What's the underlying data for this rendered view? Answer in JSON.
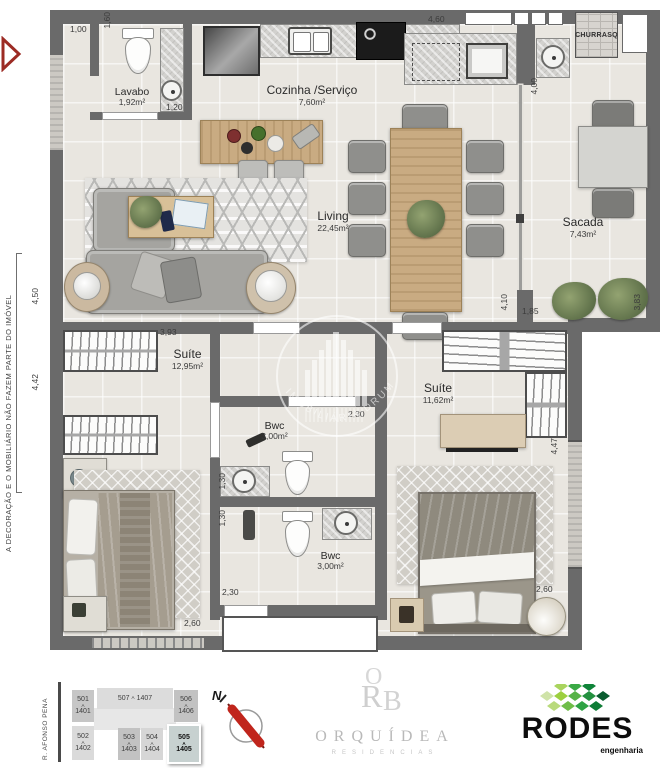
{
  "plan": {
    "rooms": {
      "lavabo": {
        "name": "Lavabo",
        "area": "1,92m²"
      },
      "cozinha": {
        "name": "Cozinha /Serviço",
        "area": "7,60m²"
      },
      "living": {
        "name": "Living",
        "area": "22,45m²"
      },
      "sacada": {
        "name": "Sacada",
        "area": "7,43m²"
      },
      "churrasqueira": {
        "name": "CHURRASQ"
      },
      "suite1": {
        "name": "Suíte",
        "area": "12,95m²"
      },
      "suite2": {
        "name": "Suíte",
        "area": "11,62m²"
      },
      "bwc1": {
        "name": "Bwc",
        "area": "3,00m²"
      },
      "bwc2": {
        "name": "Bwc",
        "area": "3,00m²"
      }
    },
    "dimensions": {
      "lavabo_top": "1,00",
      "lavabo_left": "1,60",
      "lavabo_bottom": "1,20",
      "kitchen_top": "4,60",
      "kitchen_right": "4,00",
      "living_left": "4,50",
      "suite1_top": "3,93",
      "suite1_left": "4,42",
      "suite1_bottom": "2,60",
      "bwc1_top": "2,30",
      "bwc1_left": "1,30",
      "bwc2_left": "1,30",
      "bwc2_bottom": "2,30",
      "sacada_inner": "4,10",
      "sacada_bottom": "1,85",
      "sacada_right": "3,83",
      "suite2_right": "4,47",
      "suite2_bottom": "2,60"
    },
    "disclaimer": "A DECORAÇÃO E O MOBILIÁRIO NÃO FAZEM PARTE DO IMÓVEL",
    "watermark": "IMOBILIÁRIA DRUMOND"
  },
  "footer": {
    "street": "R. AFONSO PENA",
    "unit_separator": "A",
    "units": [
      {
        "id": "501",
        "to": "1401"
      },
      {
        "id": "507",
        "to": "1407"
      },
      {
        "id": "506",
        "to": "1406"
      },
      {
        "id": "502",
        "to": "1402"
      },
      {
        "id": "503",
        "to": "1403"
      },
      {
        "id": "504",
        "to": "1404"
      },
      {
        "id": "505",
        "to": "1405"
      }
    ],
    "compass_n": "N",
    "orquidea": {
      "mono_o": "O",
      "mono_r": "R",
      "mono_b": "B",
      "name": "ORQUÍDEA",
      "subtitle": "RESIDENCIAS"
    },
    "rodes": {
      "name": "RODES",
      "subtitle": "engenharia"
    }
  },
  "colors": {
    "wall": "#6a6a6a",
    "floor": "#e9e6e0",
    "accent_red": "#a2322a",
    "needle_red": "#c0251c",
    "rodes_green": "#17913d",
    "selected_unit": "#c7d1d0"
  }
}
